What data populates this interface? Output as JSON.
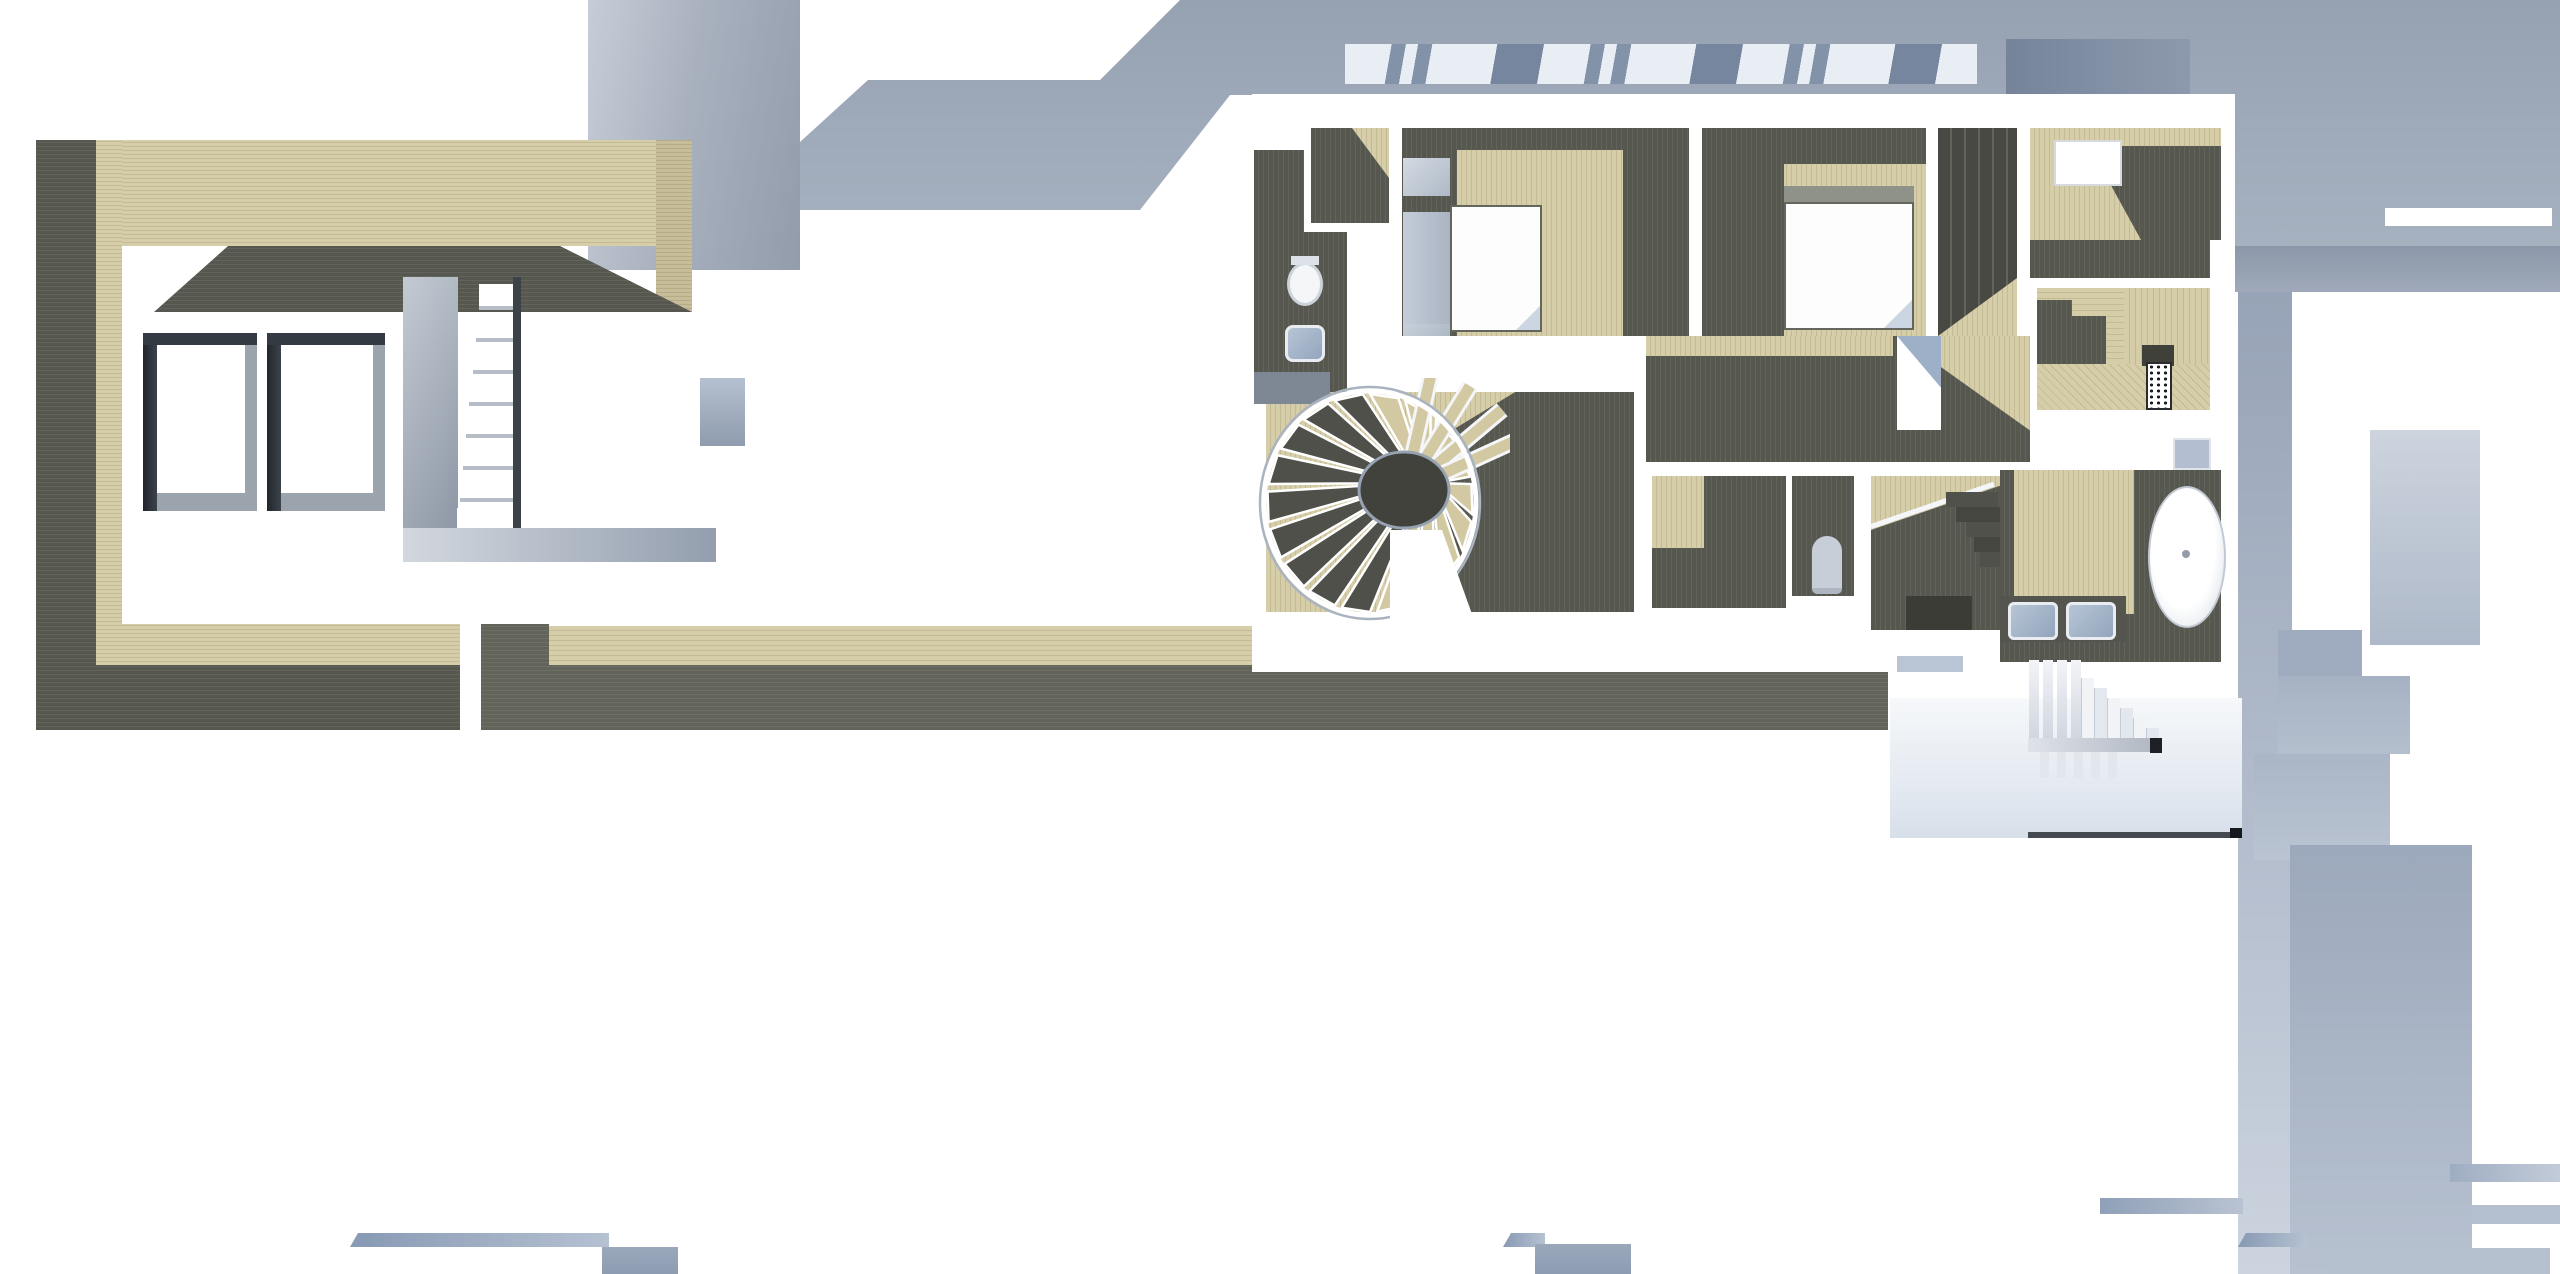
{
  "meta": {
    "title": "Architectural 3D floor-plan render, orthographic top view",
    "view": "top-down",
    "visible_text": "none"
  },
  "palette": {
    "bg": "#ffffff",
    "tan": "#d6cda9",
    "tanLine": "#c4ba95",
    "dark": "#56574f",
    "darkLine": "#62635a",
    "darkWall": "#484943",
    "darkWalk": "#626359",
    "darkWalkLine": "#6d6e64",
    "roofBlue": "#96a1b2",
    "roofBlueLight": "#a9b4c3",
    "slabLightA": "#c7cdd7",
    "slabLightB": "#929cab",
    "slabDarkA": "#76849b",
    "slabDarkB": "#8c99ad",
    "hatchWhite": "#e9eef5",
    "hatchBlue": "#8292a9",
    "steelLight": "#ccd3dc",
    "steelMid": "#9fabbc",
    "steelDark": "#7e8895",
    "frameDark": "#2e333a",
    "frameGray": "#9ba3ad",
    "fixtureBlue": "#a9b9cd",
    "nearWhite": "#f2f4f8",
    "bedWhite": "#fdfdfe",
    "bedFrame": "#63665d",
    "foldBlue": "#ccd6e2",
    "treadTan": "#d2c8a2",
    "holeDark": "#41423c",
    "rugInk": "#1c1d1f"
  },
  "scene": {
    "roof_elements": [
      "left-roof-slab",
      "main-roof-band",
      "skylight-hatch-band",
      "dark-roof-slab",
      "right-roof-field",
      "roof-vent-slit"
    ],
    "garage_structure": [
      "west-wall-shadow",
      "wood-deck-top",
      "wall-shadow-band",
      "skylight-window-1",
      "skylight-window-2",
      "garage-stair",
      "stair-landing",
      "wood-deck-bottom"
    ],
    "balcony_walkway": [
      "walkway-corner-block",
      "walkway-wood-strip",
      "walkway-shadow-strip"
    ],
    "house_rooms": [
      {
        "name": "entry-hall",
        "fixtures": []
      },
      {
        "name": "bathroom-small",
        "fixtures": [
          "toilet",
          "wash-basin"
        ]
      },
      {
        "name": "bedroom-1",
        "fixtures": [
          "bed-1",
          "nightstand-1",
          "nightstand-2"
        ]
      },
      {
        "name": "bedroom-2",
        "fixtures": [
          "bed-2",
          "headboard"
        ]
      },
      {
        "name": "closet-corridor",
        "fixtures": [
          "wardrobes"
        ]
      },
      {
        "name": "dressing-room",
        "fixtures": [
          "patterned-rug"
        ]
      },
      {
        "name": "central-hall",
        "fixtures": [
          "glazed-opening"
        ]
      },
      {
        "name": "spiral-stair-room",
        "fixtures": [
          "spiral-staircase"
        ]
      },
      {
        "name": "wc",
        "fixtures": [
          "toilet-2"
        ]
      },
      {
        "name": "inner-stairwell",
        "fixtures": [
          "descending-steps",
          "glass-rail"
        ]
      },
      {
        "name": "master-bathroom",
        "fixtures": [
          "bathtub",
          "vanity-sink-1",
          "vanity-sink-2",
          "shower-tray"
        ]
      }
    ],
    "exterior": [
      "terrace-below",
      "exterior-staircase",
      "lower-roof-masses",
      "bottom-canopy-tabs"
    ]
  }
}
